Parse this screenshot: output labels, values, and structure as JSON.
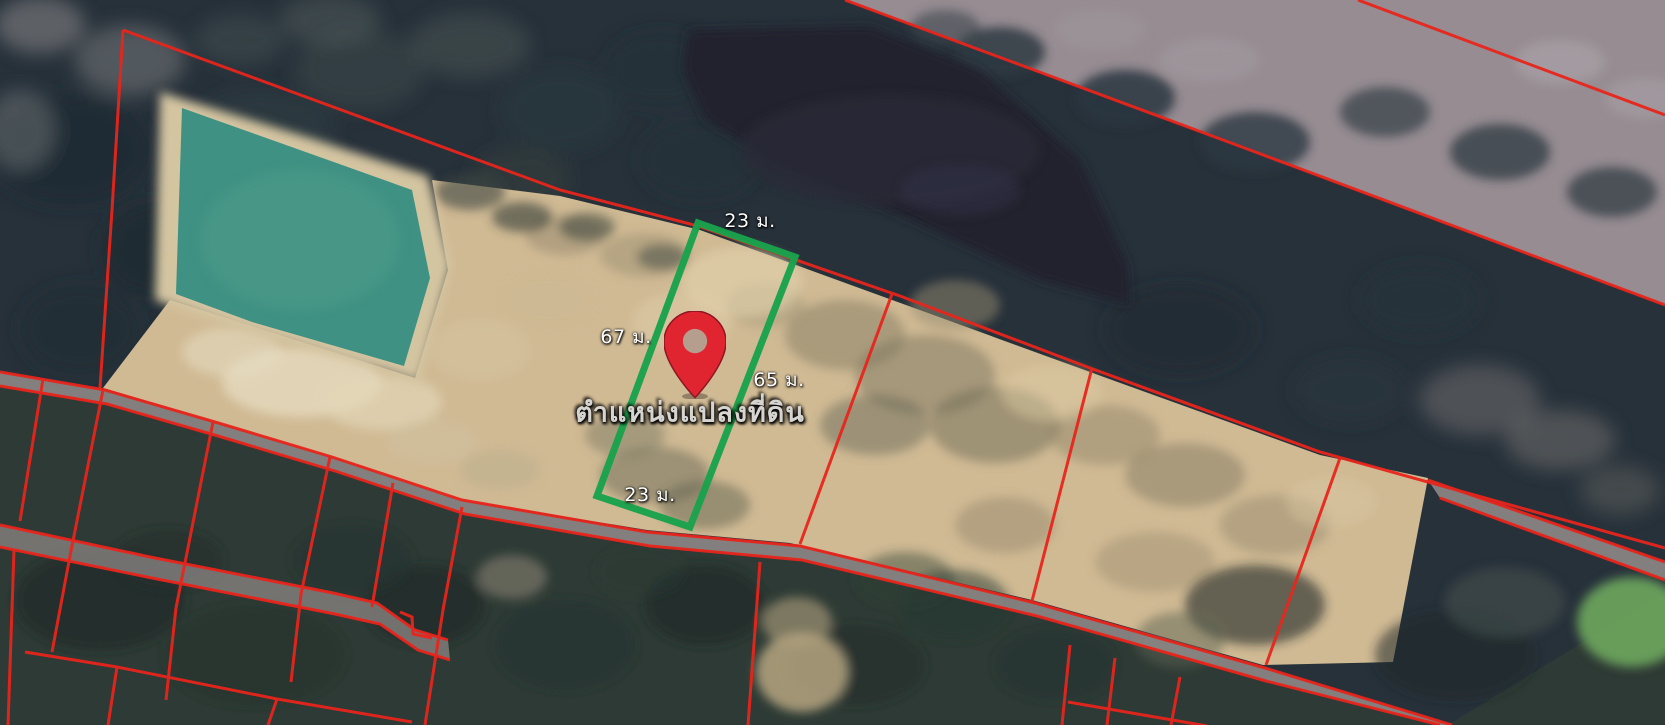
{
  "map": {
    "annotations": {
      "top_width_label": "23 ม.",
      "left_length_label": "67 ม.",
      "right_length_label": "65 ม.",
      "bottom_width_label": "23 ม.",
      "pin_caption": "ตำแหน่งแปลงที่ดิน"
    },
    "colors": {
      "parcel_boundary_red": "#e8251c",
      "highlight_green": "#1aa24c",
      "pin_red": "#e02531",
      "label_white": "#ffffff"
    }
  }
}
